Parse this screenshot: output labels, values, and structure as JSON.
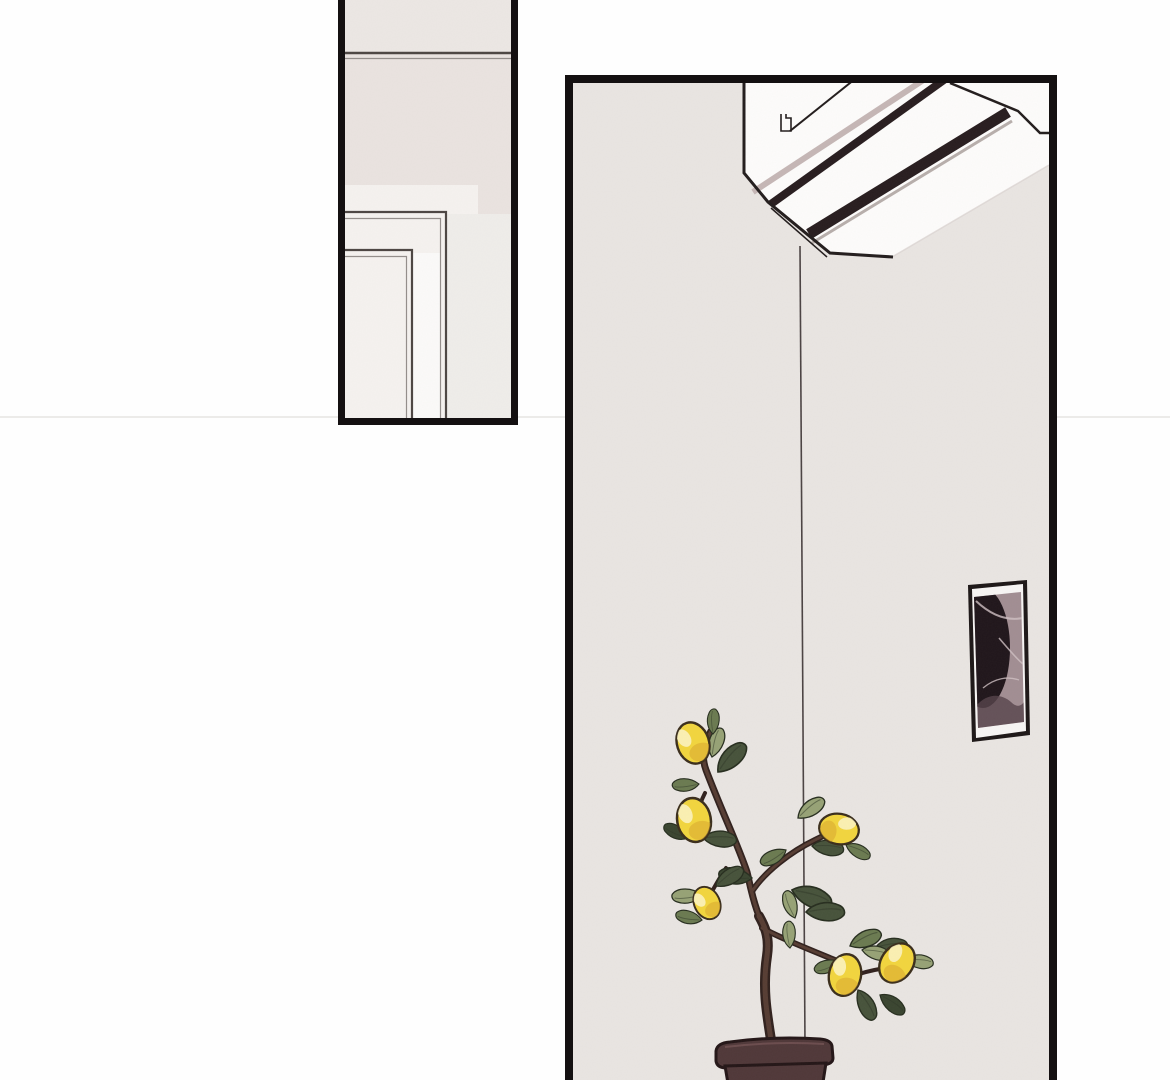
{
  "page": {
    "kind": "webtoon-comic-page",
    "panel_count": 2
  },
  "panel_doorway": {
    "label": "panel showing a wall and door-frame corner",
    "objects": [
      "wall",
      "ceiling-line",
      "door-frame"
    ]
  },
  "panel_room": {
    "label": "panel showing a room wall with air conditioner, framed picture and potted lemon tree",
    "objects": [
      "air-conditioner",
      "wall-corner-line",
      "framed-picture",
      "potted-lemon-tree"
    ],
    "lemon_count": 6
  },
  "colors": {
    "pageBg": "#fefefe",
    "seam": "#ecebe9",
    "ink": "#141011",
    "ink2": "#221c1c",
    "wall1": "#eae3e0",
    "wall1Top": "#ece7e4",
    "doorLight": "#f5f2ef",
    "doorSide": "#efedea",
    "doorWhite": "#fbfaf9",
    "frameLine": "#4c4542",
    "frameLine2": "#938d8a",
    "wall2": "#e9e5e2",
    "line": "#4a4242",
    "acWhite": "#fdfcfb",
    "slatLight": "#c5b6b5",
    "slatDark": "#271c1e",
    "slatGray": "#b7aeab",
    "softEdge": "#d8d2ce",
    "picFrame": "#1c1616",
    "picMat": "#f7f5f4",
    "artBase": "#a18d92",
    "artDark": "#1f151a",
    "artLight": "#cfc1c3",
    "artShadow": "#55424a",
    "branchDark": "#30201c",
    "branchMid": "#5d4237",
    "leafLight": "#96a275",
    "leafMid": "#6a7a50",
    "leafDark": "#46523a",
    "leafDark2": "#39442f",
    "leafOutline": "#262d1e",
    "leafVein": "#2e3626",
    "lemon": "#f2d53d",
    "lemonHi": "#fdf4c6",
    "lemonShade": "#d9a52e",
    "lemonOutline": "#3a2d1b",
    "pot": "#4f3738",
    "potOutline": "#231516",
    "potHi": "#6e4f50"
  }
}
